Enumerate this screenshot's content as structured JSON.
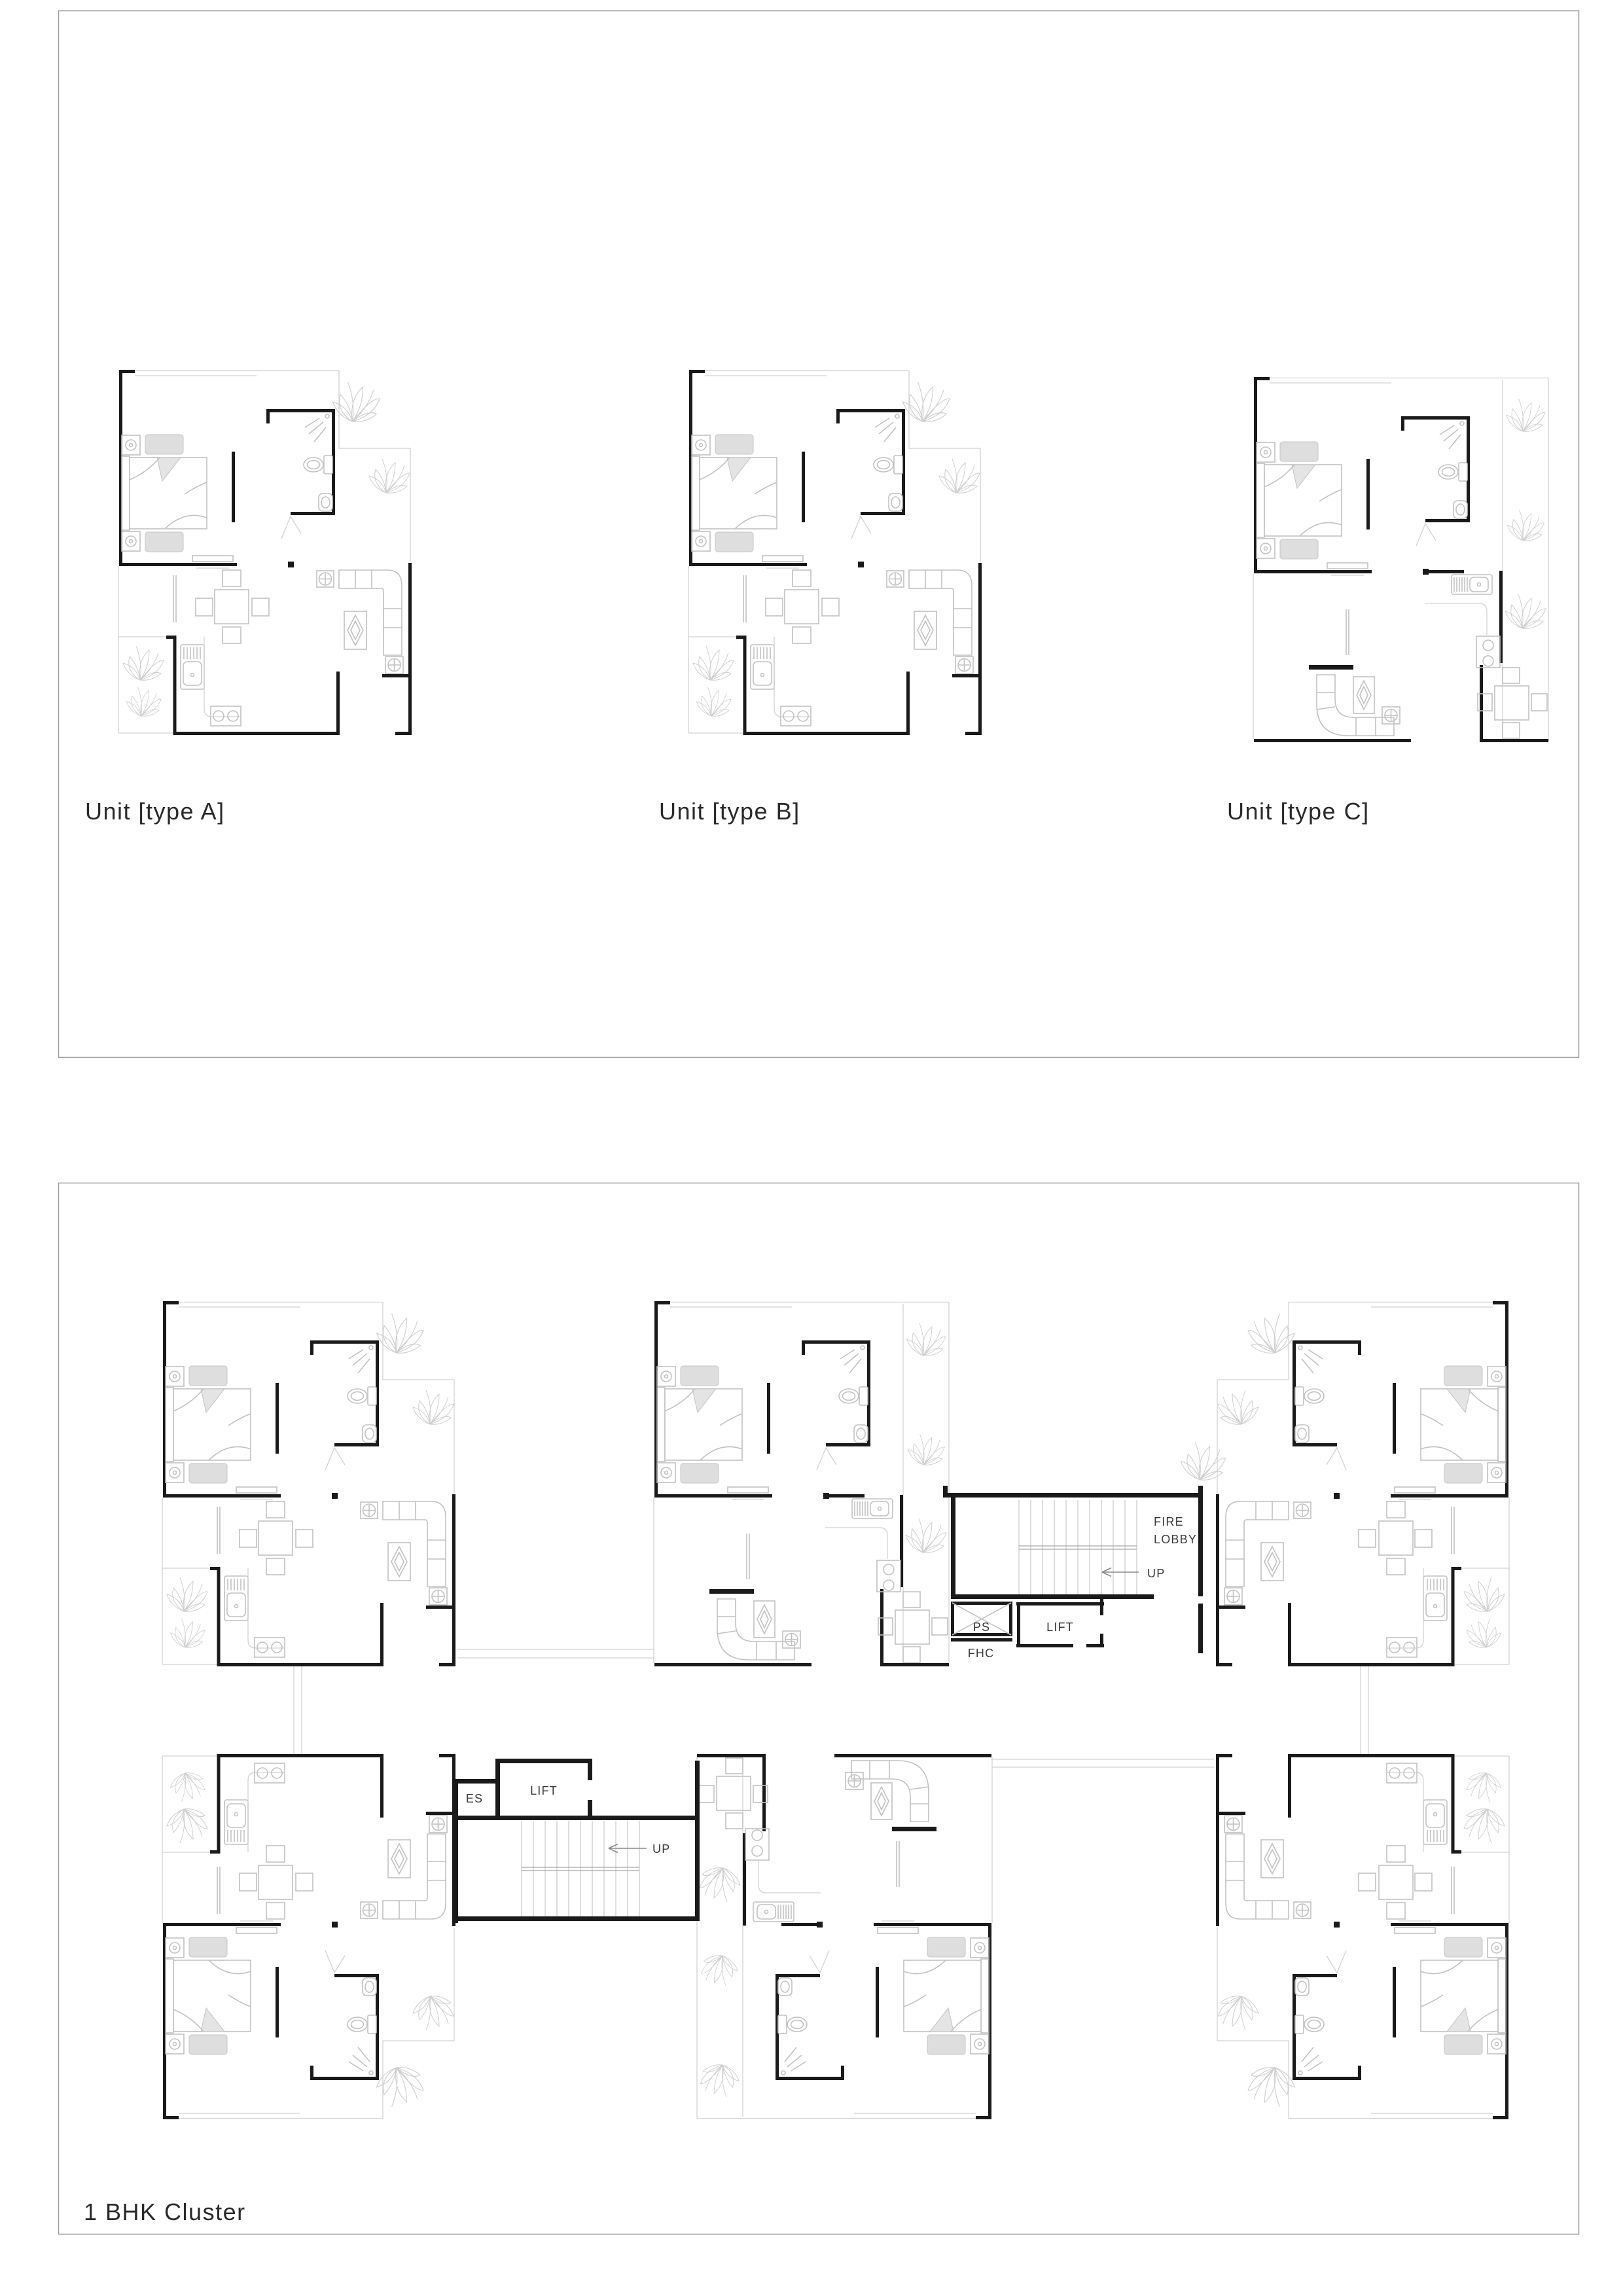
{
  "document": {
    "type": "architectural floor plan sheet",
    "sheet_background": "#ffffff"
  },
  "top_panel": {
    "unit_labels": [
      "Unit [type A]",
      "Unit [type B]",
      "Unit [type C]"
    ]
  },
  "cluster_panel": {
    "title": "1 BHK Cluster",
    "stair_core_top": {
      "fire_lobby_line1": "FIRE",
      "fire_lobby_line2": "LOBBY",
      "up": "UP",
      "ps": "PS",
      "fhc": "FHC",
      "lift": "LIFT"
    },
    "stair_core_bottom": {
      "es": "ES",
      "lift": "LIFT",
      "up": "UP"
    }
  },
  "colors": {
    "wall": "#1a1a1a",
    "furniture": "#c2c2c2",
    "faint_outline": "#d2d2d2",
    "panel_border": "#9c9c9c",
    "label_text": "#2a2a2a",
    "annotation_text": "#3a3a3a"
  }
}
